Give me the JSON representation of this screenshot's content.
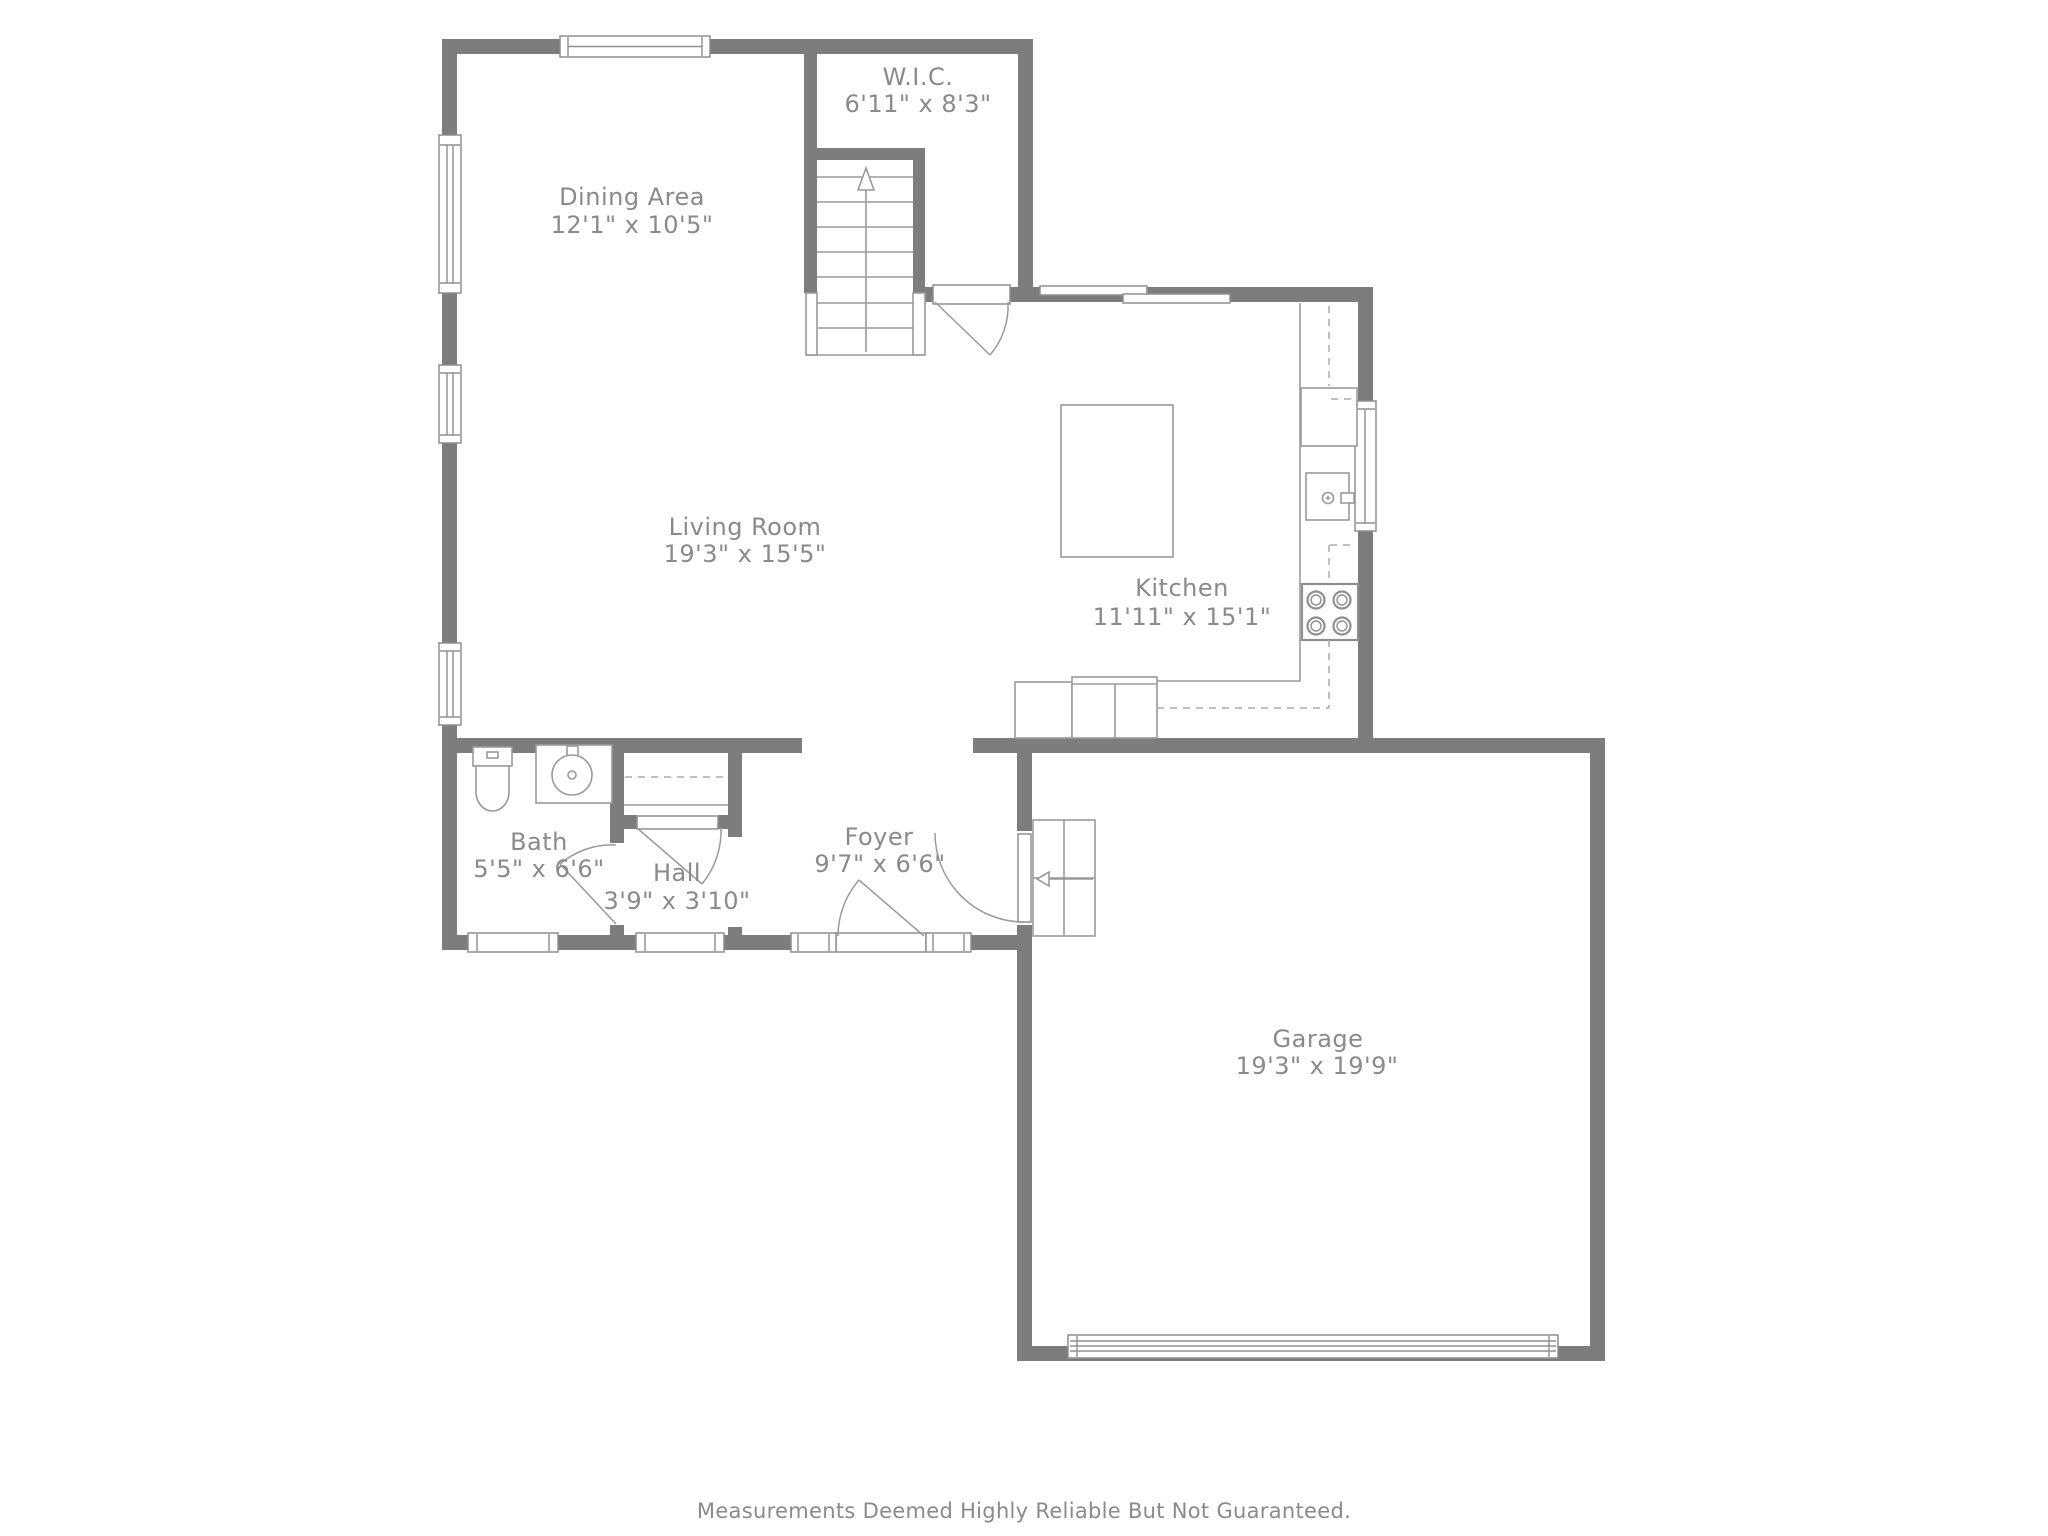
{
  "rooms": {
    "wic": {
      "name": "W.I.C.",
      "dims": "6'11\" x 8'3\""
    },
    "dining": {
      "name": "Dining Area",
      "dims": "12'1\" x 10'5\""
    },
    "living": {
      "name": "Living Room",
      "dims": "19'3\" x 15'5\""
    },
    "kitchen": {
      "name": "Kitchen",
      "dims": "11'11\" x 15'1\""
    },
    "bath": {
      "name": "Bath",
      "dims": "5'5\" x 6'6\""
    },
    "hall": {
      "name": "Hall",
      "dims": "3'9\" x 3'10\""
    },
    "foyer": {
      "name": "Foyer",
      "dims": "9'7\" x 6'6\""
    },
    "garage": {
      "name": "Garage",
      "dims": "19'3\" x 19'9\""
    }
  },
  "footer": {
    "disclaimer": "Measurements Deemed Highly Reliable But Not Guaranteed."
  },
  "colors": {
    "wall": "#7d7d7d",
    "line": "#9a9a9a",
    "dashed_line": "#ababab",
    "label_text": "#8a8a8a",
    "background": "#ffffff"
  }
}
